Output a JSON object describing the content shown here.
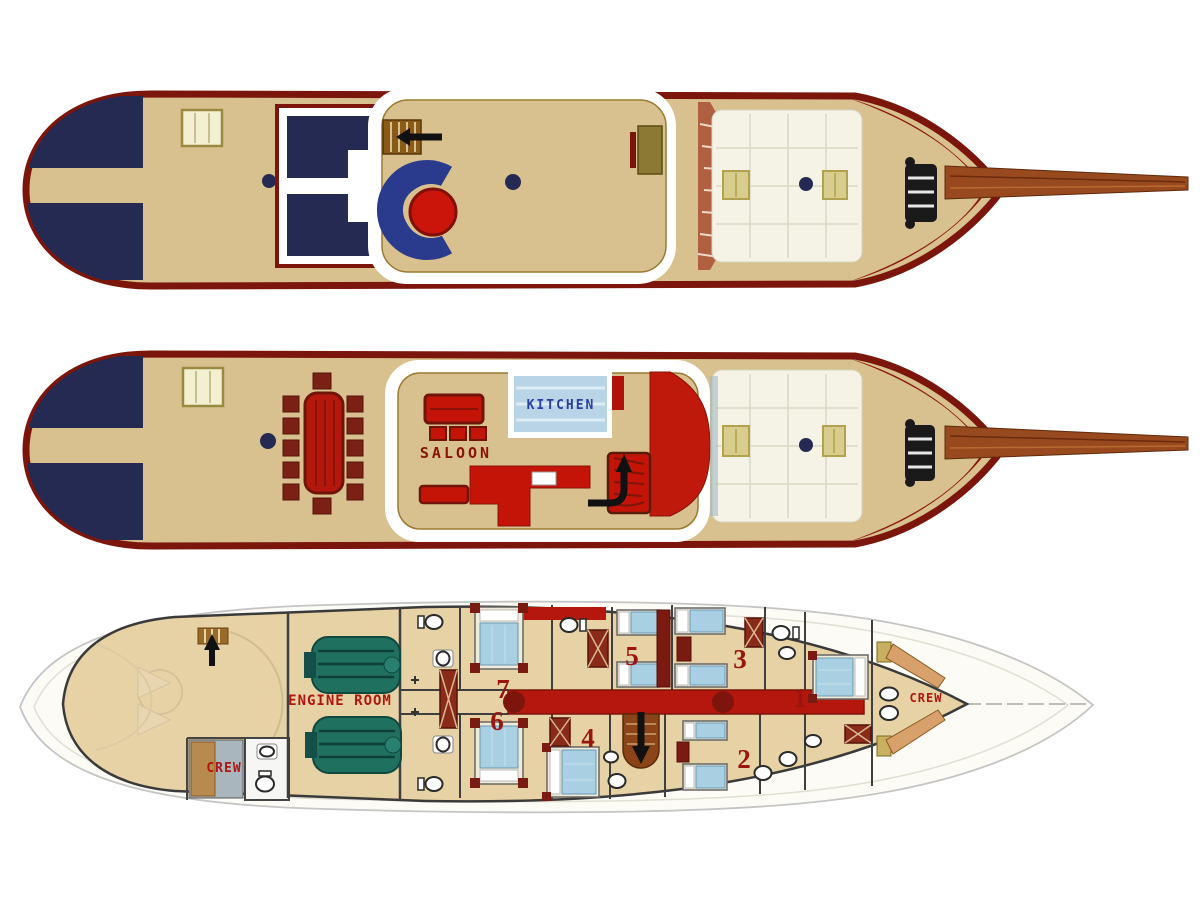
{
  "diagram": {
    "title": "yacht-three-deck-plan",
    "deck_count": 3
  },
  "labels": {
    "saloon": "SALOON",
    "kitchen": "KITCHEN",
    "engine_room": "ENGINE ROOM",
    "crew_aft": "CREW",
    "crew_bow": "CREW"
  },
  "cabins": {
    "c1": "1",
    "c2": "2",
    "c3": "3",
    "c4": "4",
    "c5": "5",
    "c6": "6",
    "c7": "7"
  },
  "colors": {
    "hull_red": "#7c150c",
    "deck_tan": "#d8c18e",
    "sunpad_navy": "#252a52",
    "foredeck_ivory": "#f5f3e6",
    "furniture_red": "#c01a0c",
    "corridor_red": "#b5170c",
    "engine_teal": "#20705f",
    "bed_blue": "#a9cfe2",
    "label_red": "#a01510",
    "kitchen_blue": "#2a3f9f",
    "lower_hull_tan": "#e6d2a4",
    "ghost_outline": "#c5c5c5"
  }
}
